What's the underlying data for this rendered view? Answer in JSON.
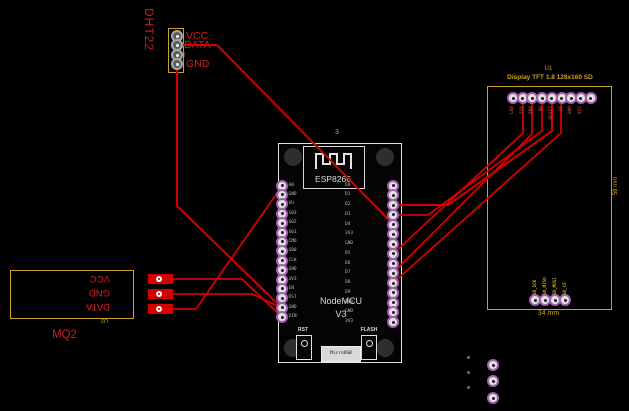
{
  "colors": {
    "trace": "#d40000",
    "silk_yellow": "#c9a11f",
    "silk_red": "#d41c1c",
    "board_white": "#e0e0e0",
    "pad_ring": "#a35fb0"
  },
  "dht22": {
    "label": "DHT22",
    "refdes": "J4",
    "pin_labels": [
      "VCC",
      "DATA",
      "GND"
    ]
  },
  "mq2": {
    "label": "MQ2",
    "refdes": "U2",
    "pin_labels": [
      "VCC",
      "GND",
      "DATA"
    ]
  },
  "nodemcu": {
    "refdes": "3",
    "chip": "ESP8266",
    "name": "NodeMCU",
    "version": "V3",
    "left_pins": [
      "A0",
      "GND",
      "VU",
      "S03",
      "S02",
      "S01",
      "CMD",
      "S00",
      "CLK",
      "GND",
      "3V3",
      "EN",
      "RST",
      "GND",
      "VIN"
    ],
    "right_pins": [
      "D0",
      "D1",
      "D2",
      "D3",
      "D4",
      "3V3",
      "GND",
      "D5",
      "D6",
      "D7",
      "D8",
      "D9",
      "D10",
      "GND",
      "3V3"
    ],
    "rst_button": "RST",
    "flash_button": "FLASH",
    "usb": "MicroUSB"
  },
  "display": {
    "refdes": "U1",
    "title": "Display TFT 1.8 128x160 SD",
    "top_pins": [
      "LED",
      "SCK",
      "SDA",
      "A0",
      "RESET",
      "CS",
      "GND",
      "VCC",
      ""
    ],
    "bottom_pins": [
      "SD_SCK",
      "SD_MISO",
      "SD_MOSI",
      "SD_CS"
    ],
    "width_label": "34 mm",
    "height_label": "58 mm"
  }
}
